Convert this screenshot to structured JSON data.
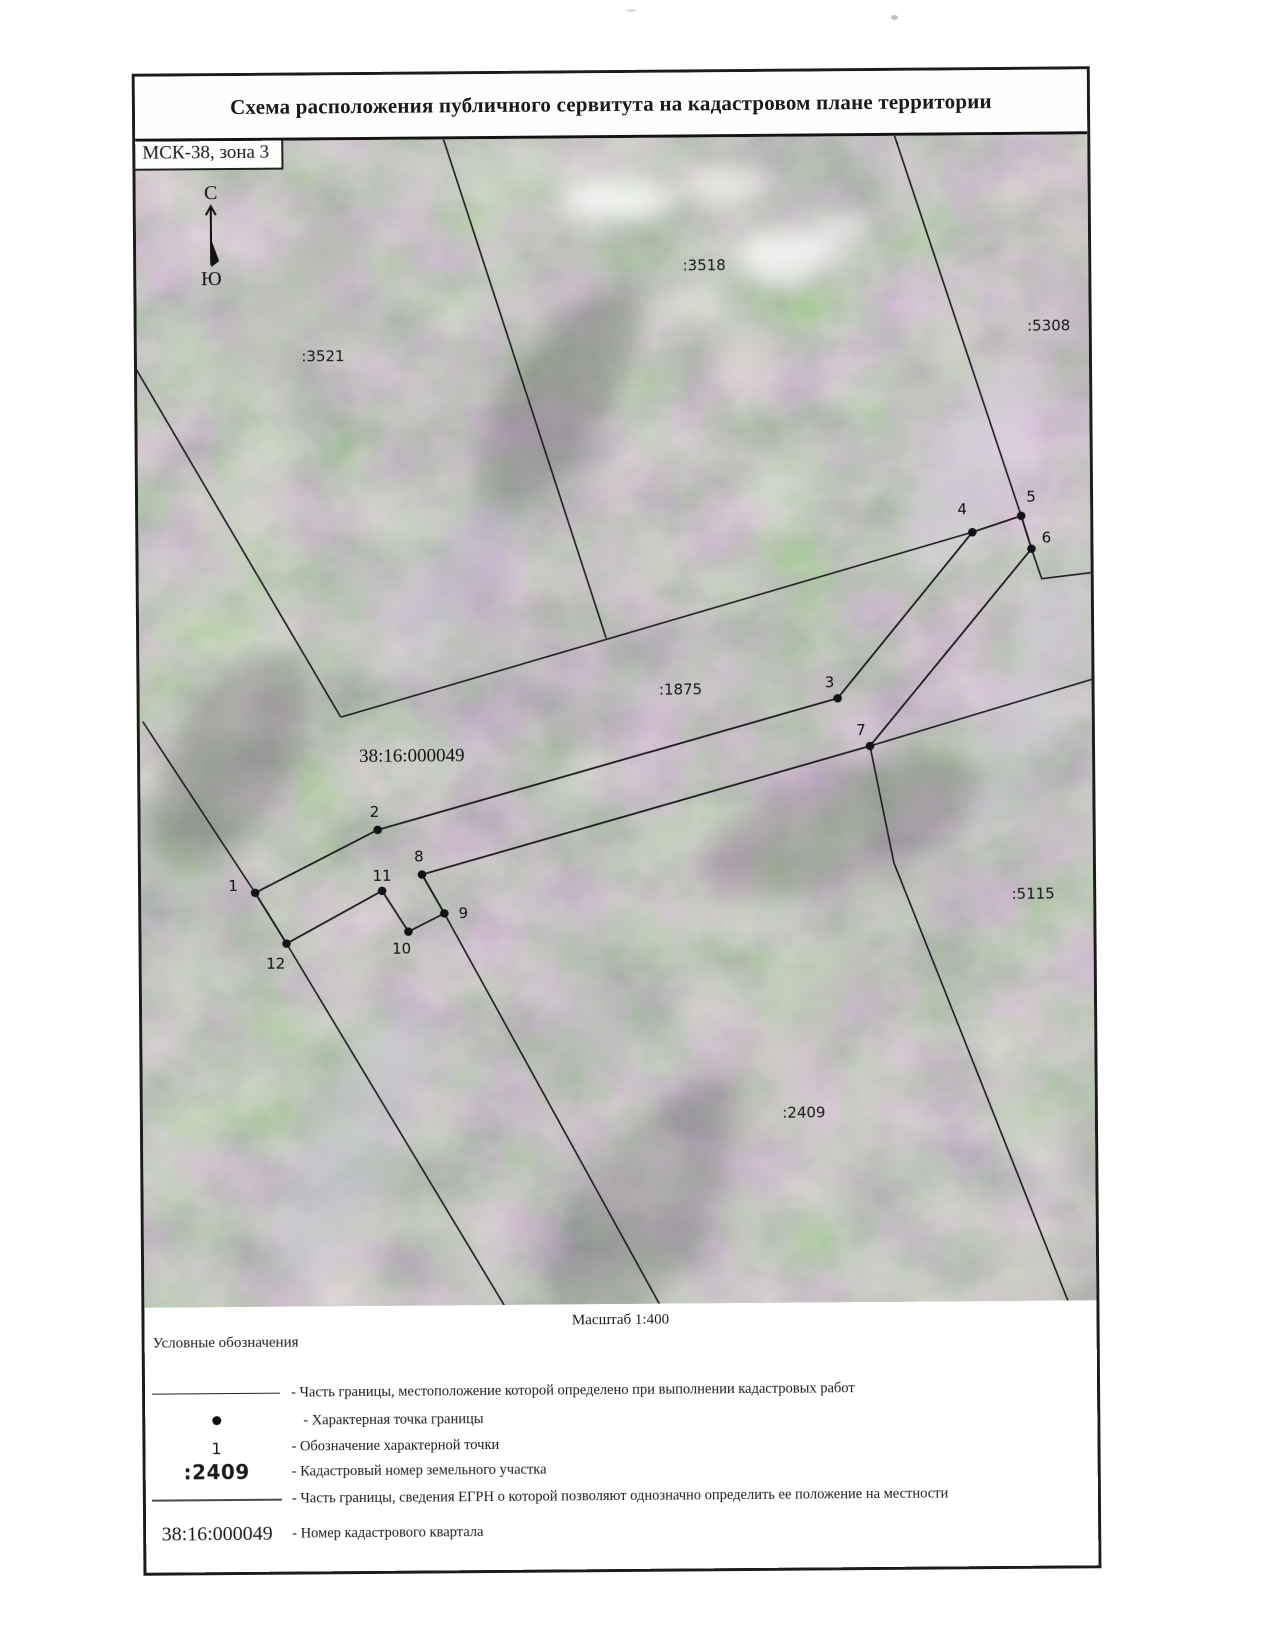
{
  "page": {
    "title": "Схема расположения публичного сервитута на кадастровом плане территории",
    "crs_label": "МСК-38, зона 3",
    "scale_text": "Масштаб 1:400"
  },
  "north": {
    "top": "С",
    "bottom": "Ю"
  },
  "colors": {
    "boundary_line": "#1b1b20",
    "point_fill": "#121217",
    "map_base_purple": "#9a8fa8",
    "map_base_green": "#7d8d7a"
  },
  "map": {
    "quarter_label": {
      "text": "38:16:000049",
      "x": 219,
      "y": 622
    },
    "parcel_labels": [
      {
        "text": ":3521",
        "x": 186,
        "y": 221
      },
      {
        "text": ":3518",
        "x": 568,
        "y": 133
      },
      {
        "text": ":5308",
        "x": 912,
        "y": 196
      },
      {
        "text": ":1875",
        "x": 541,
        "y": 557
      },
      {
        "text": ":5115",
        "x": 892,
        "y": 764
      },
      {
        "text": ":2409",
        "x": 661,
        "y": 981
      }
    ],
    "points": [
      {
        "n": "1",
        "x": 114,
        "y": 752,
        "lx": 92,
        "ly": 750
      },
      {
        "n": "2",
        "x": 237,
        "y": 690,
        "lx": 234,
        "ly": 677
      },
      {
        "n": "3",
        "x": 698,
        "y": 562,
        "lx": 690,
        "ly": 551
      },
      {
        "n": "4",
        "x": 834,
        "y": 397,
        "lx": 824,
        "ly": 379
      },
      {
        "n": "5",
        "x": 883,
        "y": 381,
        "lx": 893,
        "ly": 367
      },
      {
        "n": "6",
        "x": 893,
        "y": 414,
        "lx": 908,
        "ly": 408
      },
      {
        "n": "7",
        "x": 730,
        "y": 610,
        "lx": 721,
        "ly": 599
      },
      {
        "n": "8",
        "x": 281,
        "y": 735,
        "lx": 278,
        "ly": 722
      },
      {
        "n": "9",
        "x": 303,
        "y": 774,
        "lx": 322,
        "ly": 779
      },
      {
        "n": "10",
        "x": 267,
        "y": 792,
        "lx": 260,
        "ly": 814
      },
      {
        "n": "11",
        "x": 241,
        "y": 751,
        "lx": 241,
        "ly": 741
      },
      {
        "n": "12",
        "x": 145,
        "y": 803,
        "lx": 134,
        "ly": 828
      }
    ],
    "servitude_polygon": [
      [
        114,
        752
      ],
      [
        237,
        690
      ],
      [
        698,
        562
      ],
      [
        834,
        397
      ],
      [
        883,
        381
      ],
      [
        893,
        414
      ],
      [
        730,
        610
      ],
      [
        281,
        735
      ],
      [
        303,
        774
      ],
      [
        267,
        792
      ],
      [
        241,
        751
      ],
      [
        145,
        803
      ]
    ],
    "egrn_lines": [
      [
        [
          307,
          -4
        ],
        [
          467,
          500
        ]
      ],
      [
        [
          -4,
          222
        ],
        [
          201,
          577
        ]
      ],
      [
        [
          201,
          577
        ],
        [
          834,
          397
        ]
      ],
      [
        [
          758,
          -4
        ],
        [
          883,
          381
        ]
      ],
      [
        [
          883,
          381
        ],
        [
          893,
          414
        ],
        [
          903,
          444
        ],
        [
          956,
          438
        ]
      ],
      [
        [
          3,
          580
        ],
        [
          114,
          752
        ],
        [
          145,
          803
        ],
        [
          362,
          1170
        ]
      ],
      [
        [
          281,
          735
        ],
        [
          303,
          774
        ],
        [
          517,
          1170
        ]
      ],
      [
        [
          730,
          610
        ],
        [
          753,
          727
        ],
        [
          925,
          1170
        ]
      ],
      [
        [
          730,
          610
        ],
        [
          956,
          544
        ]
      ]
    ]
  },
  "legend": {
    "heading": "Условные обозначения",
    "rows": [
      {
        "symbol": "line-measured",
        "symbol_text": "",
        "text": "- Часть границы, местоположение которой определено при выполнении кадастровых работ"
      },
      {
        "symbol": "point",
        "symbol_text": "",
        "text": "- Характерная точка границы"
      },
      {
        "symbol": "point-number",
        "symbol_text": "1",
        "text": "- Обозначение характерной точки"
      },
      {
        "symbol": "parcel-number",
        "symbol_text": ":2409",
        "text": "- Кадастровый номер земельного участка"
      },
      {
        "symbol": "line-egrn",
        "symbol_text": "",
        "text": "- Часть границы, сведения ЕГРН о которой позволяют однозначно определить ее положение на местности"
      },
      {
        "symbol": "quarter-number",
        "symbol_text": "38:16:000049",
        "text": "- Номер кадастрового квартала"
      }
    ]
  }
}
